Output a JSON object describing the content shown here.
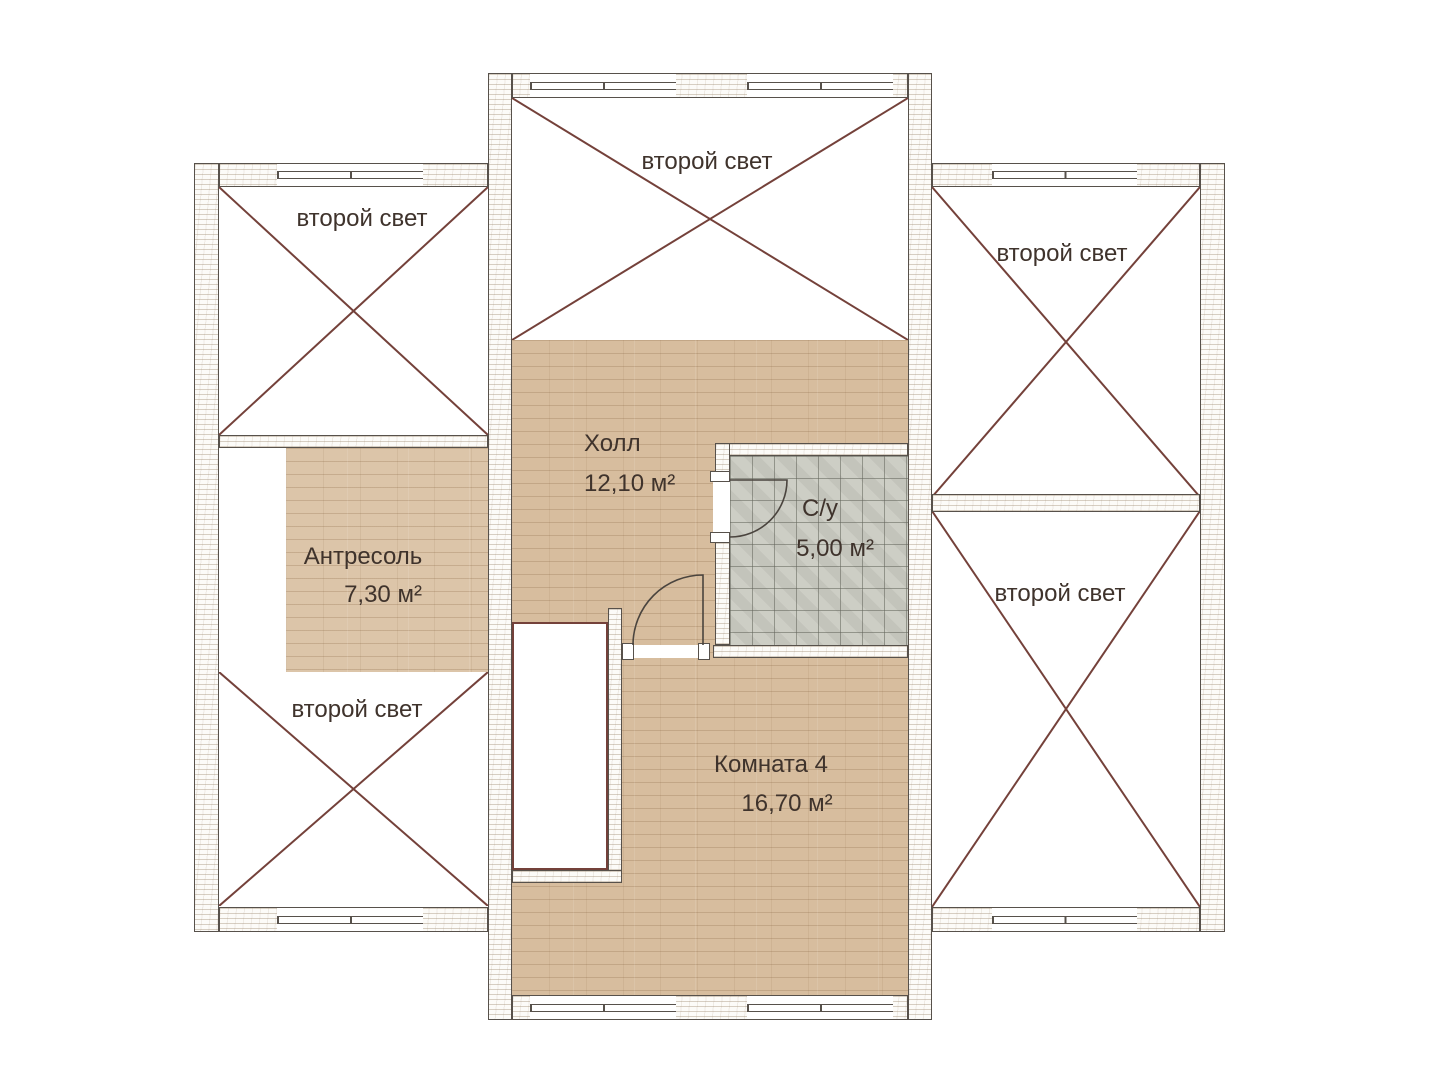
{
  "labels": {
    "double_height": {
      "left_top": "второй свет",
      "left_bottom": "второй свет",
      "center_top": "второй свет",
      "right_top": "второй свет",
      "right_bottom": "второй свет"
    }
  },
  "rooms": {
    "hall": {
      "name": "Холл",
      "area": "12,10 м²"
    },
    "bathroom": {
      "name": "С/у",
      "area": "5,00 м²"
    },
    "mezzanine": {
      "name": "Антресоль",
      "area": "7,30 м²"
    },
    "room4": {
      "name": "Комната 4",
      "area": "16,70 м²"
    }
  },
  "colors": {
    "cross_and_void_outline": "#74413a",
    "wall_outline": "#57514b",
    "wood_floor": "#d7bd9e",
    "tile_floor": "#c9cac1",
    "label_text": "#3f332c",
    "background": "#ffffff"
  }
}
